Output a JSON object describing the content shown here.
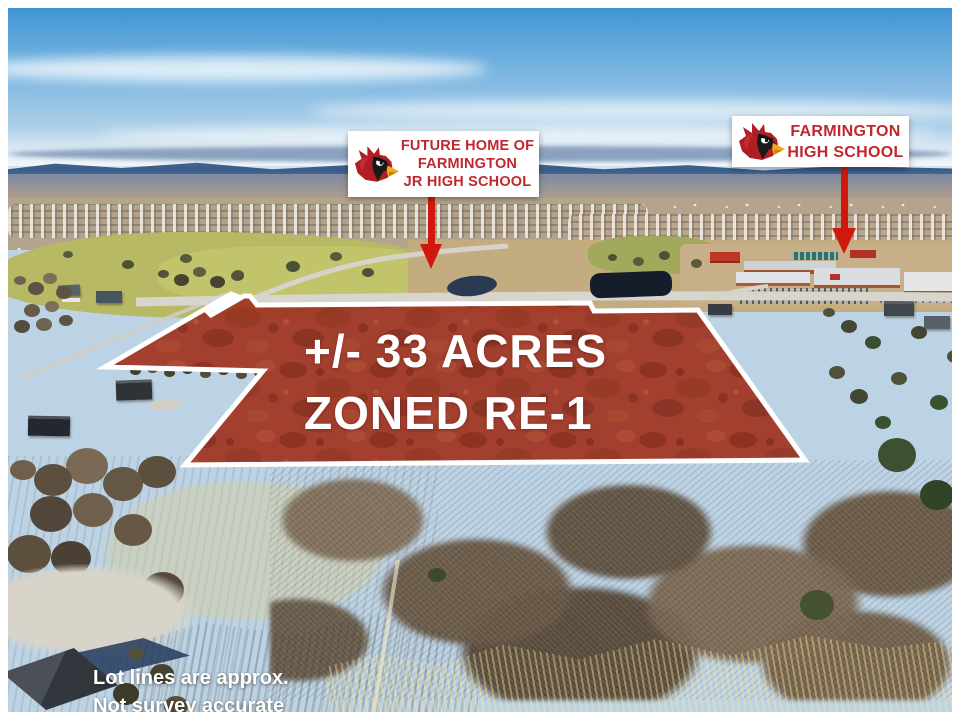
{
  "annotations": {
    "sign_jr_high": {
      "line1": "FUTURE HOME OF",
      "line2": "FARMINGTON",
      "line3": "JR HIGH SCHOOL"
    },
    "sign_high_school": {
      "line1": "FARMINGTON",
      "line2": "HIGH SCHOOL"
    },
    "parcel_label": {
      "line1": "+/- 33 ACRES",
      "line2": "ZONED RE-1"
    },
    "disclaimer": {
      "line1": "Lot lines are approx.",
      "line2": "Not survey accurate"
    }
  },
  "icons": {
    "cardinal_logo": "cardinal-head-mascot",
    "arrow_jr_high": "red-down-arrow",
    "arrow_high_school": "red-down-arrow"
  },
  "colors": {
    "sign_text": "#c1272d",
    "arrow_red": "#d0180e",
    "parcel_tint": "#a03622",
    "boundary_white": "#ffffff",
    "disclaimer_white": "#ffffff",
    "sky_blue": "#5ba6d9",
    "cardinal_red": "#b01e23",
    "beak_orange": "#f5a81c"
  }
}
